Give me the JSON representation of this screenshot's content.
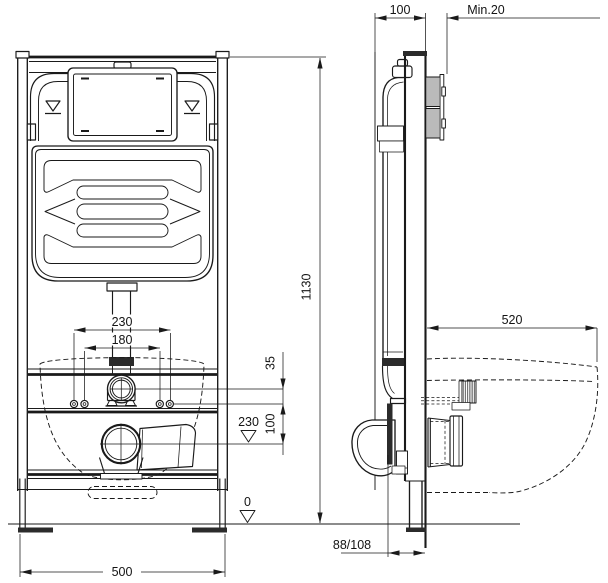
{
  "dimensions": {
    "frame_depth": "100",
    "wall_finish_min": "Min.20",
    "frame_height": "1130",
    "bowl_projection": "520",
    "fixing_centers_outer": "230",
    "fixing_centers_inner": "180",
    "flush_offset": "35",
    "fixing_to_outlet": "100",
    "outlet_level": "230",
    "floor_level": "0",
    "outlet_wall_offset": "88/108",
    "frame_width": "500"
  },
  "colors": {
    "line": "#1a1a1a",
    "background": "#ffffff"
  }
}
